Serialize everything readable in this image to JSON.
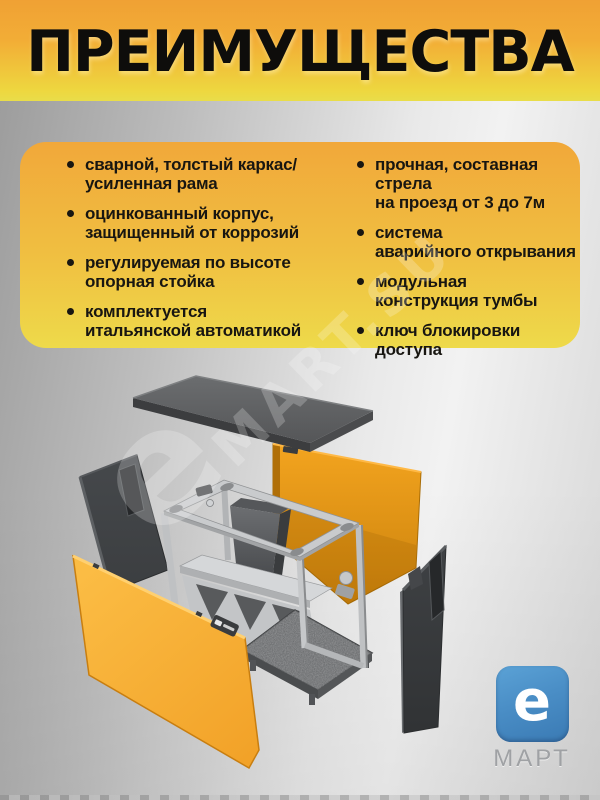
{
  "title": "ПРЕИМУЩЕСТВА",
  "advantages": {
    "left": [
      "сварной, толстый каркас/\nусиленная рама",
      "оцинкованный корпус,\nзащищенный от коррозий",
      "регулируемая по высоте\nопорная стойка",
      "комплектуется\nитальянской автоматикой"
    ],
    "right": [
      "прочная, составная стрела\nна проезд от 3 до 7м",
      "система\nаварийного открывания",
      "модульная\nконструкция тумбы",
      "ключ блокировки\nдоступа"
    ]
  },
  "watermark": {
    "e_glyph": "e",
    "text": "MART.SU"
  },
  "logo": {
    "e_glyph": "e",
    "name": "МАРТ"
  },
  "diagram": {
    "parts": [
      "top-cover-panel",
      "back-panel",
      "left-side-panel",
      "chassis-frame",
      "right-side-panel",
      "front-panel"
    ]
  },
  "colors": {
    "title_band_top": "#f0a134",
    "title_band_bottom": "#e9dd49",
    "card_top": "#f1a83a",
    "card_bottom": "#eeda4a",
    "text_black": "#181611",
    "panel_orange": "#f6ac30",
    "panel_orange_dark": "#ce830d",
    "panel_charcoal": "#3e4043",
    "frame_gray": "#c9cbcd",
    "logo_blue": "#4a8ec6",
    "logo_gray": "#9fa1a4",
    "background_gray": "#c9c9c9"
  }
}
